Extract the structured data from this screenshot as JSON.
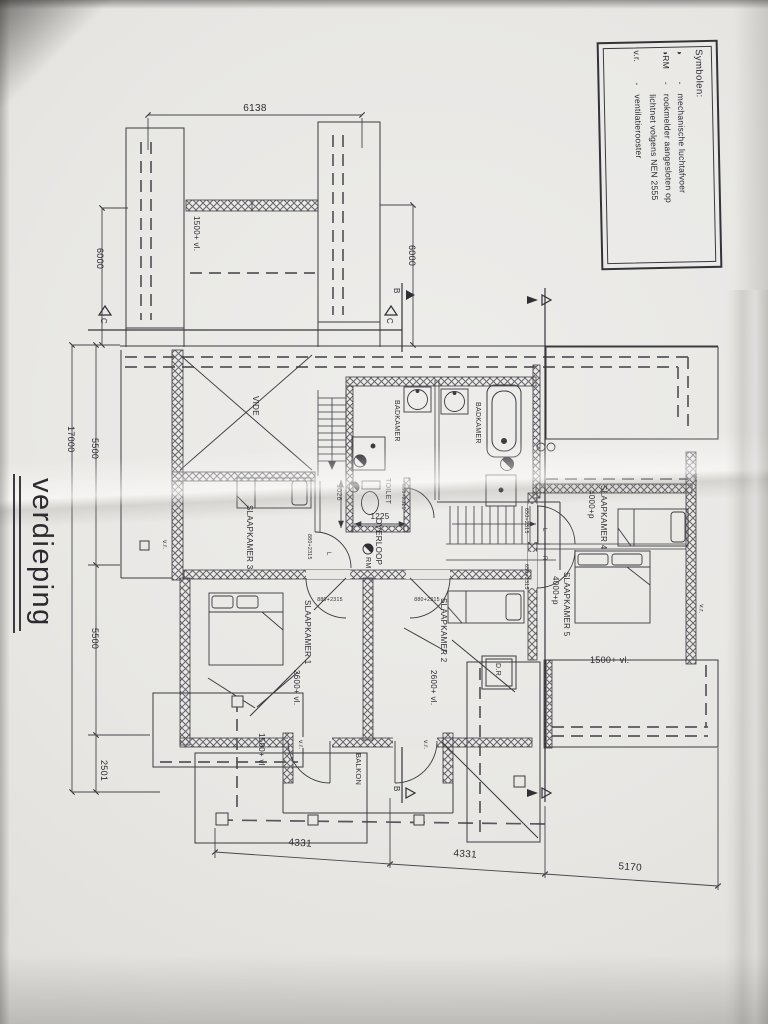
{
  "title": {
    "text": "verdieping"
  },
  "legend": {
    "title": "Symbolen:",
    "rows": [
      {
        "sym": "◑",
        "dash": "-",
        "text": "mechanische luchtafvoer"
      },
      {
        "sym": "◑RM",
        "dash": "-",
        "text": "rookmelder aangesloten op"
      },
      {
        "sym": "",
        "dash": "",
        "text": "lichtnet volgens NEN 2555"
      },
      {
        "sym": "v.r.",
        "dash": "-",
        "text": "ventilatierooster"
      }
    ]
  },
  "rooms": {
    "slaapkamer1": "SLAAPKAMER 1",
    "slaapkamer2": "SLAAPKAMER 2",
    "slaapkamer3": "SLAAPKAMER 3",
    "slaapkamer4": "SLAAPKAMER 4",
    "slaapkamer5": "SLAAPKAMER 5",
    "badkamer": "BADKAMER",
    "toilet": "TOILET",
    "overloop": "OVERLOOP",
    "vide": "VIDE",
    "balkon": "BALKON",
    "dr": "D.R."
  },
  "dimensions": {
    "top_width": "6138",
    "side_left": "6000",
    "side_right": "6000",
    "depth_total": "17000",
    "depth_upper": "5500",
    "depth_lower": "5500",
    "depth_bottom": "2501",
    "bottom_left": "4331",
    "bottom_mid": "4331",
    "bottom_right": "5170",
    "toilet_width": "1026",
    "overloop_width": "1225"
  },
  "heights": {
    "vl_1500": "1500+ vl.",
    "vl_2600": "2600+ vl.",
    "p_4000": "4000+p"
  },
  "doors": {
    "size_880": "880+2315",
    "size_650": "650+2315",
    "hinge_left": "L",
    "hinge_right": "R"
  },
  "symbols": {
    "rm": "RM",
    "vr": "v.r."
  },
  "sections": {
    "b": "B",
    "c": "C"
  }
}
